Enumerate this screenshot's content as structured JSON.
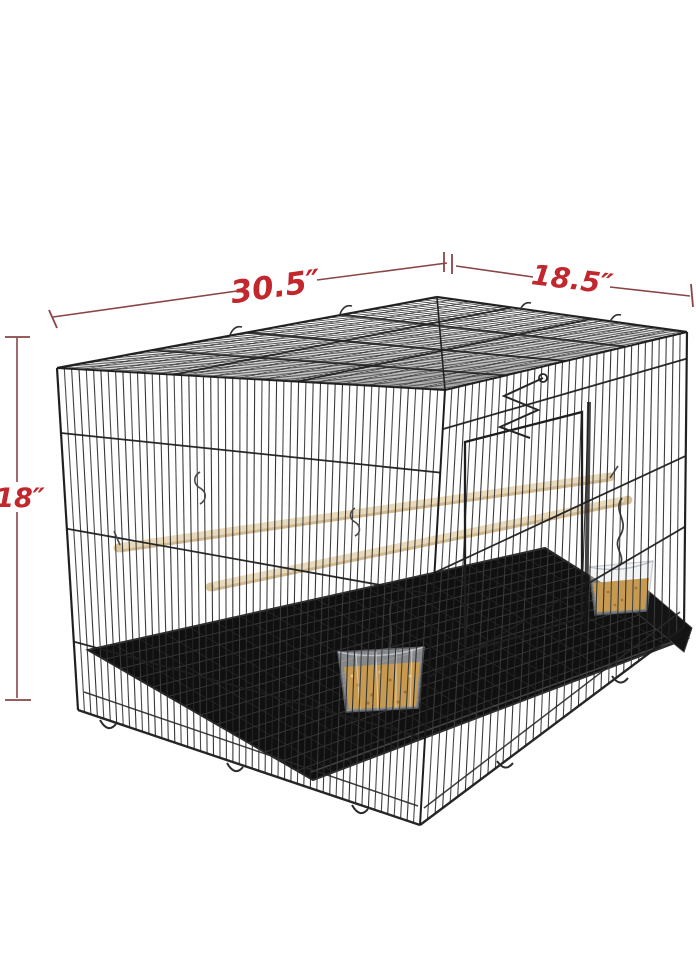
{
  "page": {
    "background_color": "#ffffff"
  },
  "annotations": {
    "width_label": "30.5″",
    "depth_label": "18.5″",
    "height_label": "18″",
    "text_color": "#c1272d",
    "line_color": "#8a4545"
  },
  "product": {
    "subject": "Black metal wire flight bird cage with slide-out tray, two wooden perches and two clear seed cups",
    "wire_color": "#2b2b2b",
    "tray_color": "#101010",
    "perch_color": "#e8dabb",
    "seed_color": "#c79a52"
  }
}
